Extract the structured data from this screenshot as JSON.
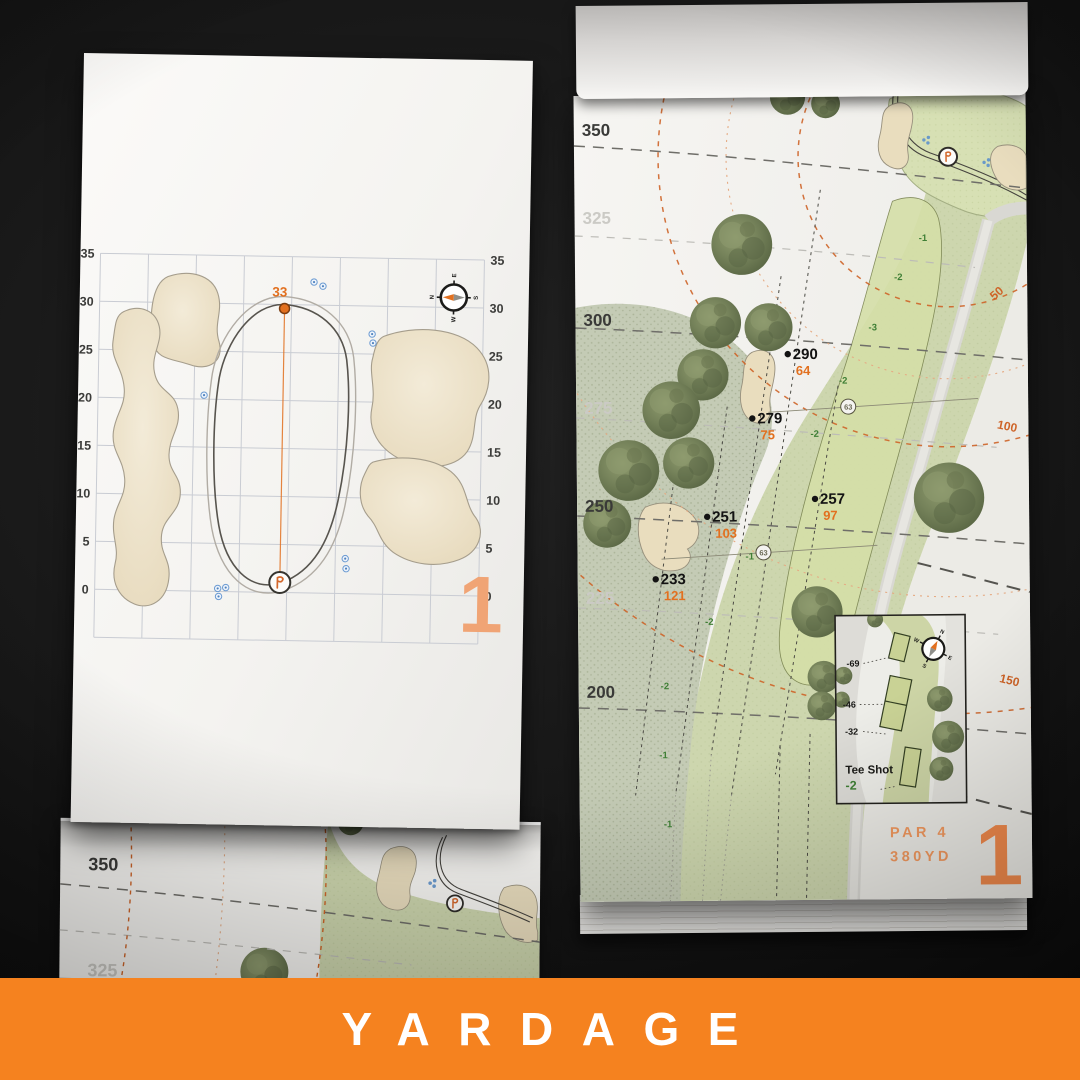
{
  "banner": {
    "title": "YARDAGE",
    "color": "#F5821F"
  },
  "compass": {
    "n": "N",
    "e": "E",
    "s": "S",
    "w": "W"
  },
  "left_page": {
    "depth_marker": "33",
    "page_number": "1",
    "axis": [
      "35",
      "30",
      "25",
      "20",
      "15",
      "10",
      "5",
      "0"
    ]
  },
  "right_page": {
    "page_number": "1",
    "par_label": "PAR 4",
    "distance_label": "380YD",
    "yardage_lines": [
      "350",
      "325",
      "300",
      "275",
      "250",
      "225",
      "200"
    ],
    "arc_labels": [
      "50",
      "100",
      "150"
    ],
    "markers": [
      {
        "carry": "290",
        "remaining": "64"
      },
      {
        "carry": "279",
        "remaining": "75"
      },
      {
        "carry": "257",
        "remaining": "97"
      },
      {
        "carry": "251",
        "remaining": "103"
      },
      {
        "carry": "233",
        "remaining": "121"
      }
    ],
    "width_markers": [
      "63",
      "63"
    ],
    "slope_labels": [
      "-1",
      "-2",
      "-3",
      "-2",
      "-2",
      "-1",
      "-2",
      "-2",
      "-1",
      "-1"
    ],
    "tee_inset": {
      "title": "Tee Shot",
      "total": "-2",
      "tee_distances": [
        "-69",
        "-46",
        "-32"
      ]
    }
  },
  "under_page": {
    "yardage_lines": [
      "350",
      "325"
    ]
  },
  "colors": {
    "accent_orange": "#F5821F",
    "marker_orange": "#E2701F",
    "slope_green": "#3F7F35",
    "arc_orange": "#CE6428"
  }
}
